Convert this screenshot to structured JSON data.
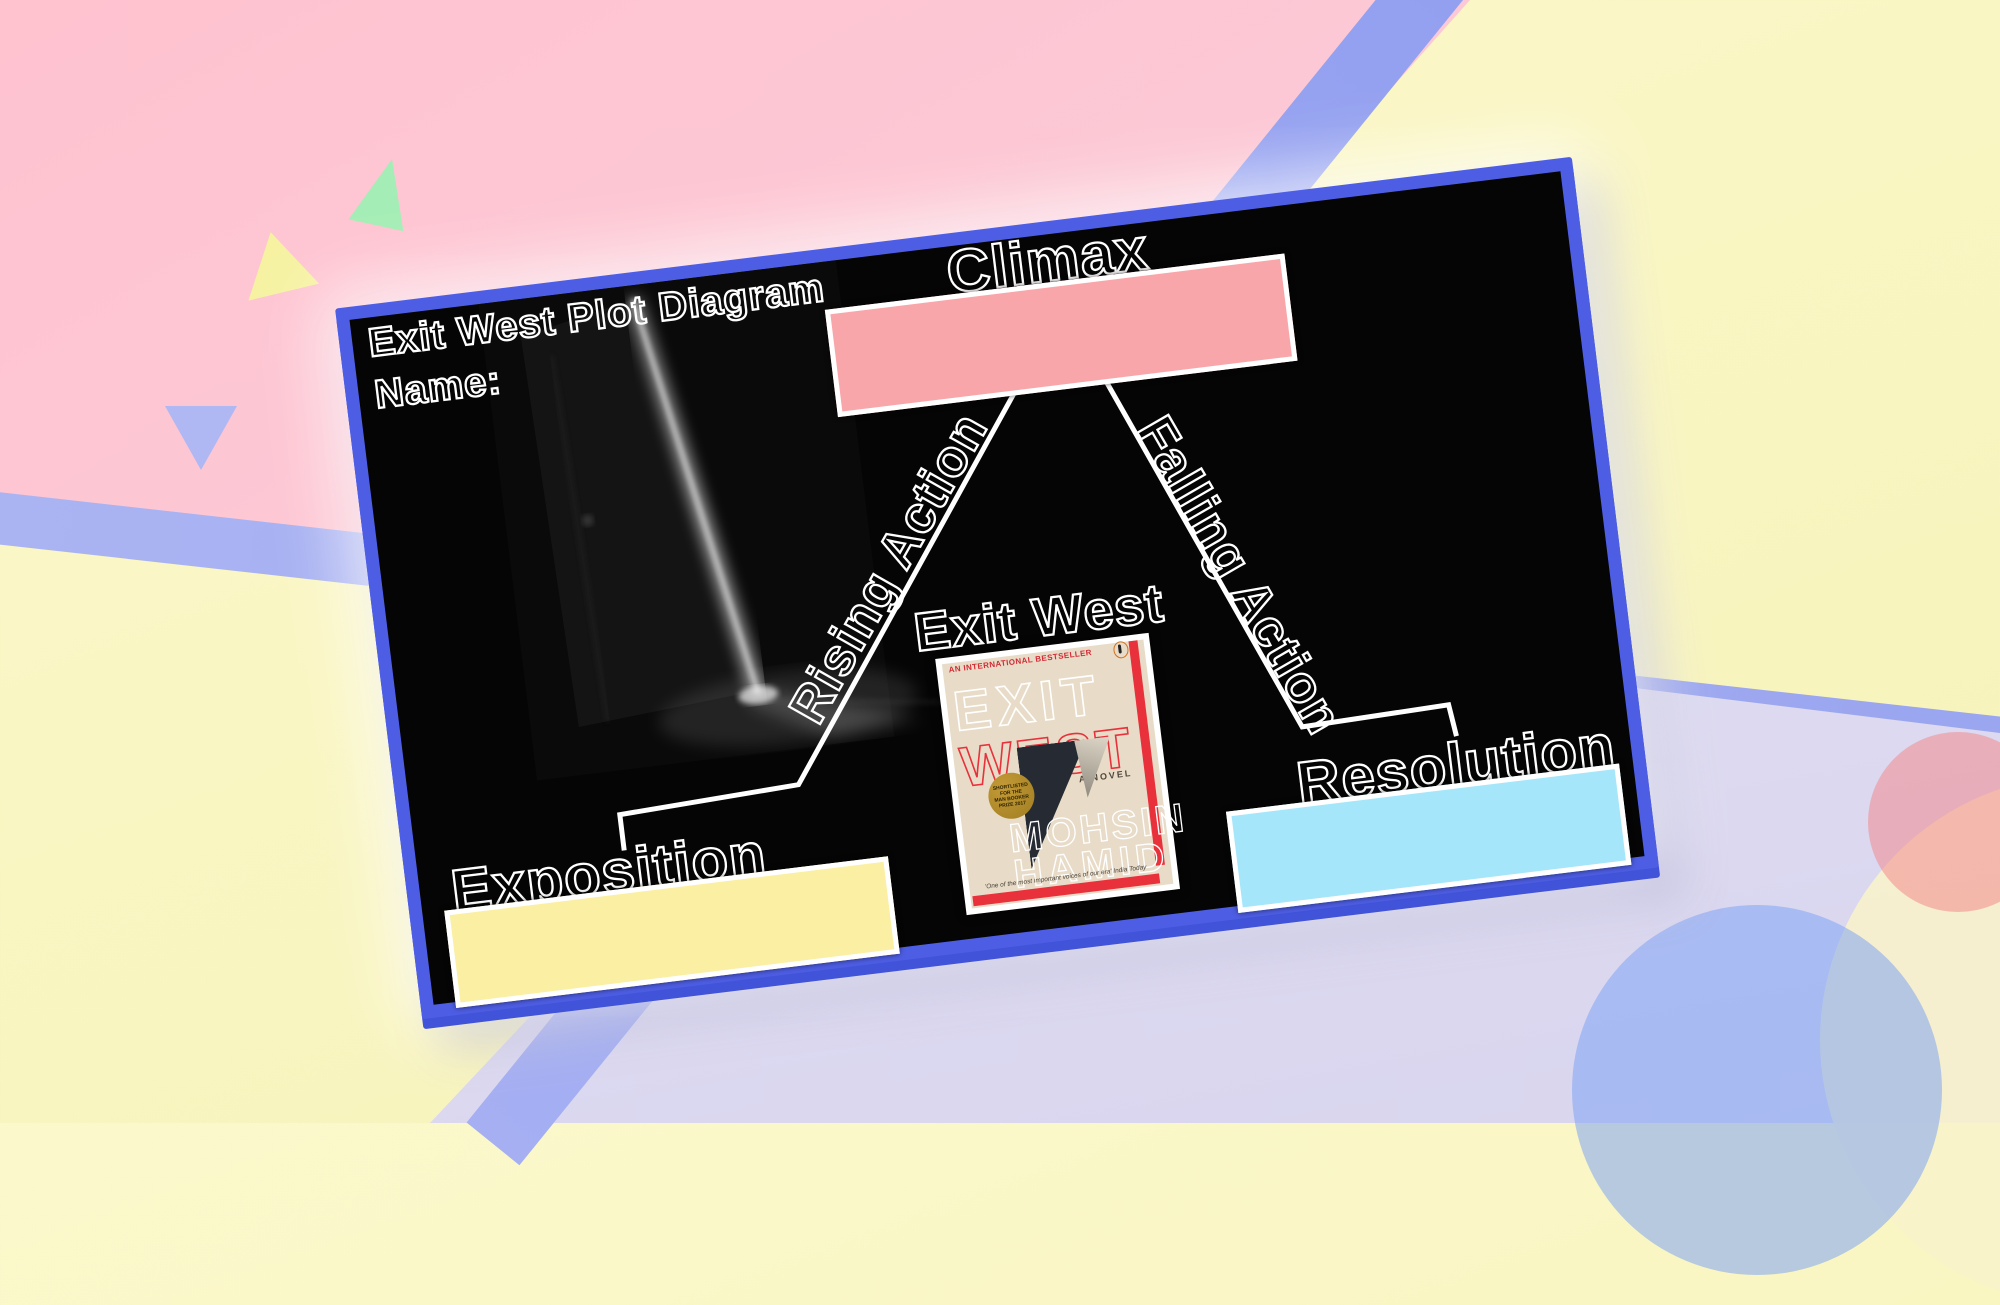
{
  "slide": {
    "title": "Exit West Plot Diagram",
    "name_label": "Name:",
    "stages": {
      "climax": "Climax",
      "rising": "Rising Action",
      "falling": "Falling Action",
      "exposition": "Exposition",
      "resolution": "Resolution"
    },
    "book_label": "Exit West",
    "book_cover": {
      "tagline": "AN INTERNATIONAL BESTSELLER",
      "title_line1": "EXIT",
      "title_line2": "WEST",
      "subtitle": "A NOVEL",
      "badge_lines": [
        "SHORTLISTED",
        "FOR THE",
        "MAN BOOKER",
        "PRIZE 2017"
      ],
      "author_line1": "MOHSIN",
      "author_line2": "HAMID",
      "review": "'One of the most important voices of our era' India Today"
    },
    "colors": {
      "slide_background": "#050505",
      "slide_border": "#4E5EE4",
      "climax_box": "#F9A6AA",
      "exposition_box": "#FAEFA3",
      "resolution_box": "#A5E6FB",
      "connector_lines": "#FFFFFF",
      "outline_text": "#FFFFFF"
    }
  },
  "background": {
    "colors": {
      "pink": "#FFC2CF",
      "pale_yellow": "#FAF7C5",
      "lavender": "#DFDCF2",
      "periwinkle_stripe": "#9BA7F0",
      "circle_blue": "#80A4F4",
      "circle_salmon": "#F38B8E",
      "circle_cream": "#F8F3CB",
      "triangle_green": "#A5EDB6",
      "triangle_yellow": "#F6F2A2",
      "triangle_lavender": "#AFB8F3"
    }
  }
}
